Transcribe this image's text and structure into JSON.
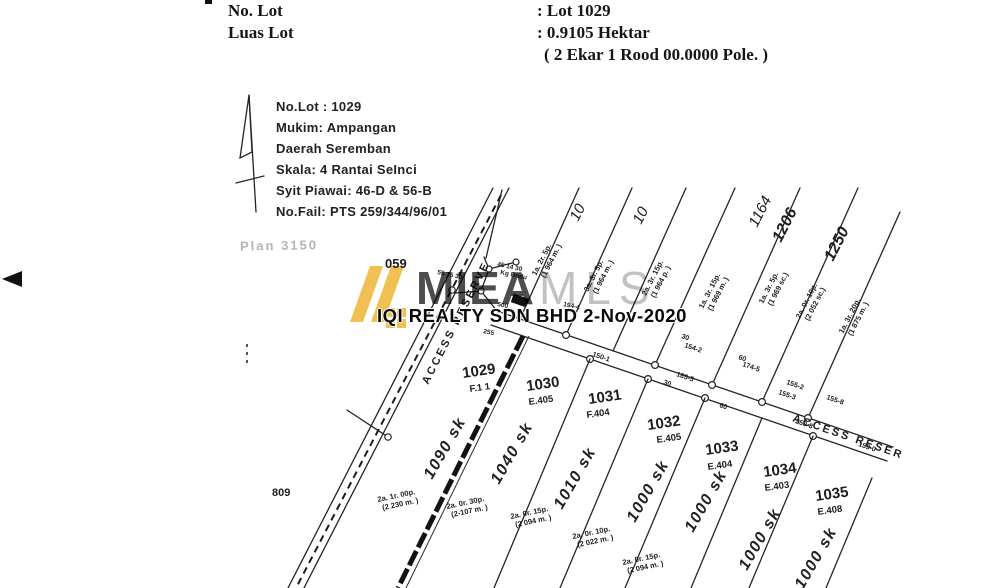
{
  "header": {
    "rows": [
      {
        "label": "No. Lot",
        "value": ": Lot 1029"
      },
      {
        "label": "Luas Lot",
        "value": ": 0.9105 Hektar"
      },
      {
        "label": "",
        "value": "( 2 Ekar 1 Rood 00.0000 Pole. )"
      }
    ]
  },
  "info_block": {
    "lines": [
      "No.Lot : 1029",
      "Mukim: Ampangan",
      "Daerah Seremban",
      "Skala: 4 Rantai SeInci",
      "Syit Piawai: 46-D & 56-B",
      "No.Fail: PTS 259/344/96/01"
    ]
  },
  "watermark": {
    "brand_primary": "MIEA",
    "brand_secondary": "MLS",
    "logo_color": "#f0c052",
    "primary_color": "#4d4d4d",
    "secondary_color": "#c2c2c2",
    "stamp_text": "IQI REALTY SDN BHD 2-Nov-2020"
  },
  "map": {
    "corner_label": "059",
    "left_label": "809",
    "plan_note": "Plan 3150",
    "road_upper_name": "ACCESS RESERVE",
    "road_lower_name": "ACCESS RESER",
    "lots": [
      {
        "number": "1029",
        "ref": "F.1 1",
        "sk": "1090 sk"
      },
      {
        "number": "1030",
        "ref": "E.405",
        "sk": "1040 sk"
      },
      {
        "number": "1031",
        "ref": "F.404",
        "sk": "1010 sk"
      },
      {
        "number": "1032",
        "ref": "E.405",
        "sk": "1000 sk"
      },
      {
        "number": "1033",
        "ref": "E.404",
        "sk": "1000 sk"
      },
      {
        "number": "1034",
        "ref": "E.403",
        "sk": "1000 sk"
      },
      {
        "number": "1035",
        "ref": "E.408",
        "sk": "1000 sk"
      }
    ],
    "areas": [
      {
        "l1": "2a. 1r. 00p.",
        "l2": "(2 230 m. )"
      },
      {
        "l1": "2a. 0r. 30p.",
        "l2": "(2-107 m. )"
      },
      {
        "l1": "2a. 0r. 15p.",
        "l2": "(2 094 m. )"
      },
      {
        "l1": "2a. 0r. 10p.",
        "l2": "(2 022 m. )"
      },
      {
        "l1": "2a. 0r. 15p.",
        "l2": "(2 094 m. )"
      }
    ],
    "upper_annotations": [
      {
        "l1": "1a. 2r. 5p.",
        "l2": "(1 964 m. )"
      },
      {
        "l1": "3a. 3r. 5p.",
        "l2": "(1 964 m. )"
      },
      {
        "l1": "2a. 3r. 15p.",
        "l2": "(1 964 p. )"
      },
      {
        "l1": "1a. 3r. 15p.",
        "l2": "(1 969 m. )"
      },
      {
        "l1": "1a. 3r. 5p.",
        "l2": "(1 969 sc.)"
      },
      {
        "l1": "2a. 0r. 10p.",
        "l2": "(2 052 sc.)"
      },
      {
        "l1": "1a. 3r. 20p.",
        "l2": "(1 875 m. )"
      }
    ],
    "strip_numbers": [
      "10",
      "10",
      "1164",
      "1206",
      "1250"
    ],
    "road_labels": [
      "154-2",
      "174-5",
      "155-2",
      "155-8",
      "150-1",
      "185-5",
      "155-3",
      "250-8",
      "159-0"
    ],
    "bearings": [
      "30",
      "30",
      "60",
      "60"
    ],
    "junction_labels": [
      "45 14 30",
      "Kg Bndu",
      "55 15 30",
      "500",
      "194-4",
      "255"
    ]
  }
}
